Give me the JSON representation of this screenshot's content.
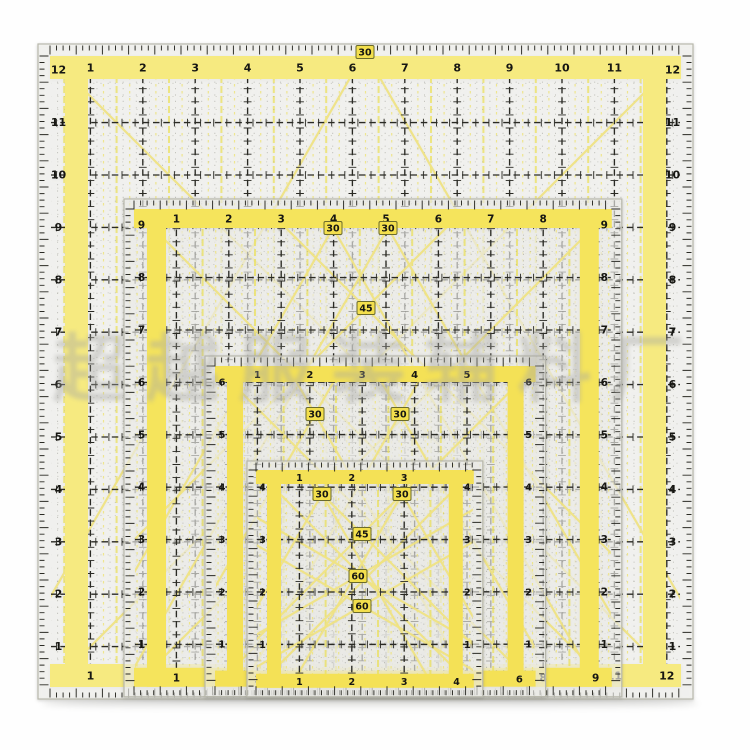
{
  "photo": {
    "subject": "nested-quilting-rulers",
    "background": "#fefefe"
  },
  "watermark": {
    "text": "超越服装辅料厂"
  },
  "unit_px": 52.4,
  "colors": {
    "grid": "#2a2a24",
    "minor_gray": "#6a6a5e",
    "yellow_half_line": "#ece055",
    "yellow_quarter_line": "#efe47e",
    "diagonal": "#f0e382",
    "number": "#161612",
    "acrylic_edge": "#b8b8ac",
    "acrylic_fill": "rgba(252,252,249,0.60)",
    "angle_box_bg": "#f3df4d",
    "angle_box_border": "#6b6b2c"
  },
  "rulers": [
    {
      "name": "ruler-12-5-inch",
      "x": 38,
      "y": 44,
      "inches": 12.5,
      "units": 12,
      "margin": 12,
      "strip": 15,
      "band": 23,
      "band_color": "#f6ea80",
      "number_size": 11,
      "top_numbers": [
        1,
        2,
        3,
        4,
        5,
        6,
        7,
        8,
        9,
        10,
        11
      ],
      "bottom_numbers": [
        1,
        2,
        3,
        4,
        5,
        6,
        7,
        8,
        9,
        10,
        11,
        12
      ],
      "side_numbers": [
        12,
        11,
        10,
        9,
        8,
        7,
        6,
        5,
        4,
        3,
        2,
        1
      ],
      "angle_labels": [
        {
          "text": "30",
          "x": 365,
          "y": 52
        }
      ]
    },
    {
      "name": "ruler-9-5-inch",
      "x": 124,
      "y": 199,
      "inches": 9.5,
      "units": 9,
      "margin": 10,
      "strip": 13,
      "band": 19,
      "band_color": "#f5e45c",
      "number_size": 10.5,
      "top_numbers": [
        1,
        2,
        3,
        4,
        5,
        6,
        7,
        8
      ],
      "bottom_numbers": [
        1,
        2,
        3,
        4,
        5,
        6,
        7,
        8,
        9
      ],
      "side_numbers": [
        9,
        8,
        7,
        6,
        5,
        4,
        3,
        2,
        1
      ],
      "angle_labels": [
        {
          "text": "30",
          "x": 333,
          "y": 228
        },
        {
          "text": "30",
          "x": 388,
          "y": 228
        },
        {
          "text": "45",
          "x": 366,
          "y": 308
        }
      ]
    },
    {
      "name": "ruler-6-5-inch",
      "x": 205,
      "y": 356,
      "inches": 6.5,
      "units": 6,
      "margin": 10,
      "strip": 12,
      "band": 16,
      "band_color": "#f4e156",
      "number_size": 10,
      "top_numbers": [
        1,
        2,
        3,
        4,
        5
      ],
      "bottom_numbers": [
        1,
        2,
        3,
        4,
        5,
        6
      ],
      "side_numbers": [
        6,
        5,
        4,
        3,
        2,
        1
      ],
      "angle_labels": [
        {
          "text": "30",
          "x": 315,
          "y": 414
        },
        {
          "text": "30",
          "x": 400,
          "y": 414
        }
      ]
    },
    {
      "name": "ruler-4-5-inch",
      "x": 247,
      "y": 461,
      "inches": 4.5,
      "units": 4,
      "margin": 9,
      "strip": 11,
      "band": 14,
      "band_color": "#f4e156",
      "number_size": 9.5,
      "top_numbers": [
        1,
        2,
        3
      ],
      "bottom_numbers": [
        1,
        2,
        3,
        4
      ],
      "side_numbers": [
        4,
        3,
        2,
        1
      ],
      "angle_labels": [
        {
          "text": "30",
          "x": 322,
          "y": 494
        },
        {
          "text": "30",
          "x": 402,
          "y": 494
        },
        {
          "text": "45",
          "x": 362,
          "y": 534
        },
        {
          "text": "60",
          "x": 358,
          "y": 576
        },
        {
          "text": "60",
          "x": 362,
          "y": 606
        }
      ]
    }
  ]
}
